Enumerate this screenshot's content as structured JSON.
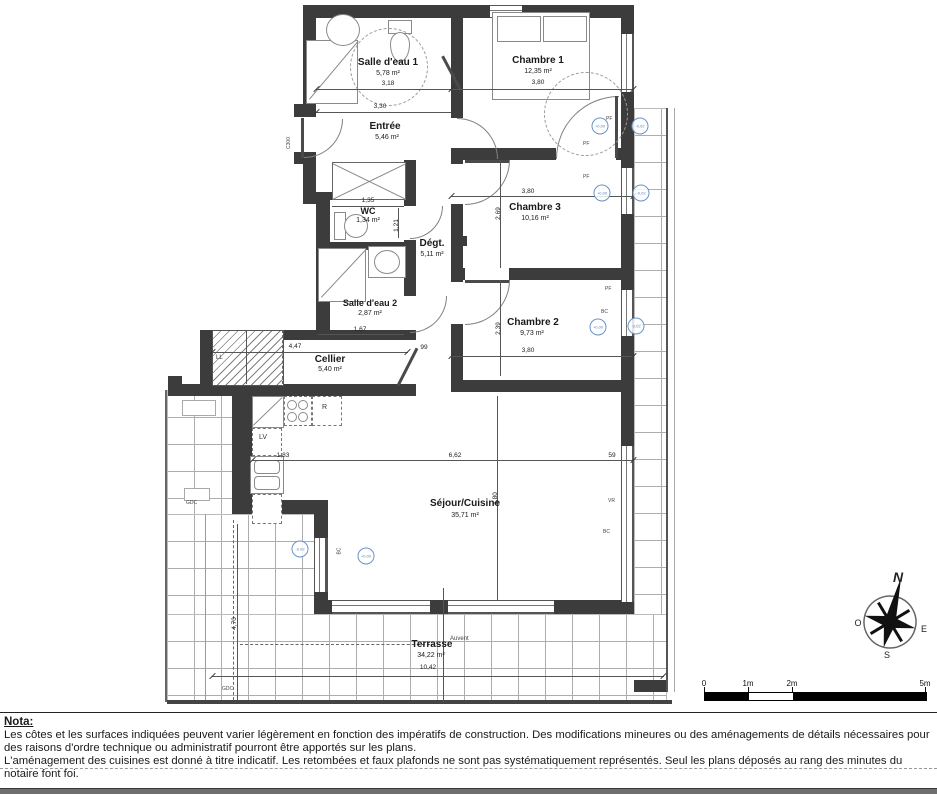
{
  "rooms": {
    "sde1": {
      "name": "Salle d'eau 1",
      "area": "5,78 m²"
    },
    "chambre1": {
      "name": "Chambre 1",
      "area": "12,35 m²"
    },
    "entree": {
      "name": "Entrée",
      "area": "5,46 m²"
    },
    "wc": {
      "name": "WC",
      "area": "1,34 m²"
    },
    "degt": {
      "name": "Dégt.",
      "area": "5,11 m²"
    },
    "chambre3": {
      "name": "Chambre 3",
      "area": "10,16 m²"
    },
    "sde2": {
      "name": "Salle d'eau 2",
      "area": "2,87 m²"
    },
    "chambre2": {
      "name": "Chambre 2",
      "area": "9,73 m²"
    },
    "cellier": {
      "name": "Cellier",
      "area": "5,40 m²"
    },
    "sejour": {
      "name": "Séjour/Cuisine",
      "area": "35,71 m²"
    },
    "terrasse": {
      "name": "Terrasse",
      "area": "34,22 m²"
    }
  },
  "dims": {
    "sde1_w": "3,18",
    "ch1_w": "3,80",
    "entree_w": "3,30",
    "wc_w": "1,35",
    "wc_h": "1,21",
    "ch3_w": "3,80",
    "ch3_h": "2,69",
    "ch2_w": "3,80",
    "ch2_h": "2,39",
    "sde2_w": "1,67",
    "cellier_w": "4,47",
    "degt_w": "99",
    "kitchen_w": "1,83",
    "sejour_w": "6,62",
    "sejour_e": "59",
    "sejour_h": "4,80",
    "terrasse_w": "10,42",
    "terrasse_h": "4,70"
  },
  "annotations": {
    "entry_door": "C300",
    "fridge": "R",
    "dishwasher": "LV",
    "washer": "LL",
    "gdc": "GDC",
    "auvent": "Auvent",
    "bc": "BC",
    "vr": "VR",
    "pf": "PF",
    "level_zero": "+0,00",
    "level_neg": "-0,02"
  },
  "compass": {
    "north": "N",
    "south": "S",
    "east": "E",
    "west": "O"
  },
  "scale": {
    "t0": "0",
    "t1": "1m",
    "t2": "2m",
    "t5": "5m"
  },
  "nota": {
    "title": "Nota:",
    "p1": "Les côtes et les surfaces indiquées peuvent varier légèrement en fonction des impératifs de construction. Des modifications mineures ou des aménagements de détails nécessaires pour des raisons d'ordre technique ou administratif pourront être apportés sur les plans.",
    "p2": "L'aménagement des cuisines est donné à titre indicatif. Les retombées et faux plafonds ne sont pas systématiquement représentés. Seul les plans déposés au rang des minutes du notaire font foi."
  }
}
